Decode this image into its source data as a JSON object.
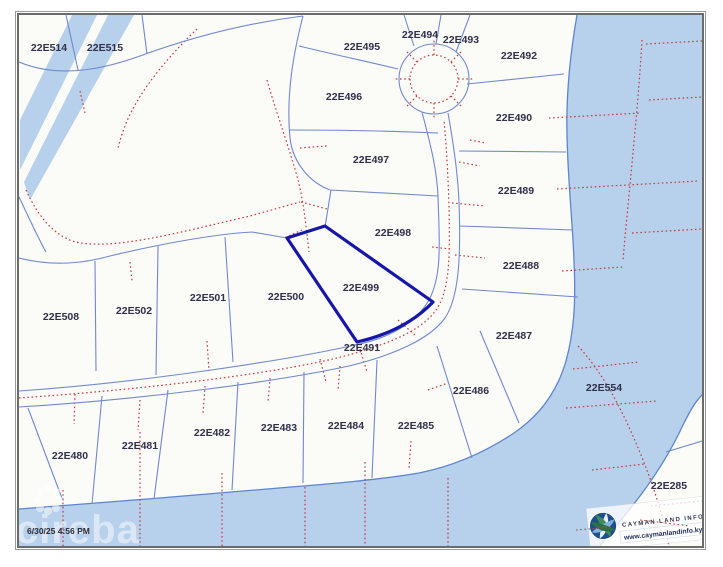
{
  "map": {
    "timestamp": "6/30/25 4:56 PM",
    "watermark": "cireba",
    "highlighted_parcel": "22E499",
    "attribution": {
      "logo_title": "CAYMAN LAND INFO",
      "logo_url": "www.caymanlandinfo.ky"
    },
    "colors": {
      "water": "#b7d0ec",
      "shoreline": "#5c85cc",
      "parcel_line": "#7089ce",
      "survey_dotted": "#c43c3c",
      "highlight": "#1616aa",
      "label": "#30304a",
      "land": "#fbfbf8"
    },
    "parcels": [
      {
        "id": "22E514",
        "x": 49,
        "y": 51
      },
      {
        "id": "22E515",
        "x": 105,
        "y": 51
      },
      {
        "id": "22E495",
        "x": 362,
        "y": 50
      },
      {
        "id": "22E494",
        "x": 420,
        "y": 38
      },
      {
        "id": "22E493",
        "x": 461,
        "y": 43
      },
      {
        "id": "22E492",
        "x": 519,
        "y": 59
      },
      {
        "id": "22E496",
        "x": 344,
        "y": 100
      },
      {
        "id": "22E490",
        "x": 514,
        "y": 121
      },
      {
        "id": "22E497",
        "x": 371,
        "y": 163
      },
      {
        "id": "22E489",
        "x": 516,
        "y": 194
      },
      {
        "id": "22E498",
        "x": 393,
        "y": 236
      },
      {
        "id": "22E488",
        "x": 521,
        "y": 269
      },
      {
        "id": "22E499",
        "x": 361,
        "y": 291,
        "highlighted": true
      },
      {
        "id": "22E500",
        "x": 286,
        "y": 300
      },
      {
        "id": "22E501",
        "x": 208,
        "y": 301
      },
      {
        "id": "22E502",
        "x": 134,
        "y": 314
      },
      {
        "id": "22E508",
        "x": 61,
        "y": 320
      },
      {
        "id": "22E487",
        "x": 514,
        "y": 339
      },
      {
        "id": "22E491",
        "x": 362,
        "y": 351
      },
      {
        "id": "22E486",
        "x": 471,
        "y": 394
      },
      {
        "id": "22E554",
        "x": 604,
        "y": 391
      },
      {
        "id": "22E485",
        "x": 416,
        "y": 429
      },
      {
        "id": "22E484",
        "x": 346,
        "y": 429
      },
      {
        "id": "22E483",
        "x": 279,
        "y": 431
      },
      {
        "id": "22E482",
        "x": 212,
        "y": 436
      },
      {
        "id": "22E481",
        "x": 140,
        "y": 449
      },
      {
        "id": "22E480",
        "x": 70,
        "y": 459
      },
      {
        "id": "22E285",
        "x": 669,
        "y": 489
      }
    ]
  }
}
